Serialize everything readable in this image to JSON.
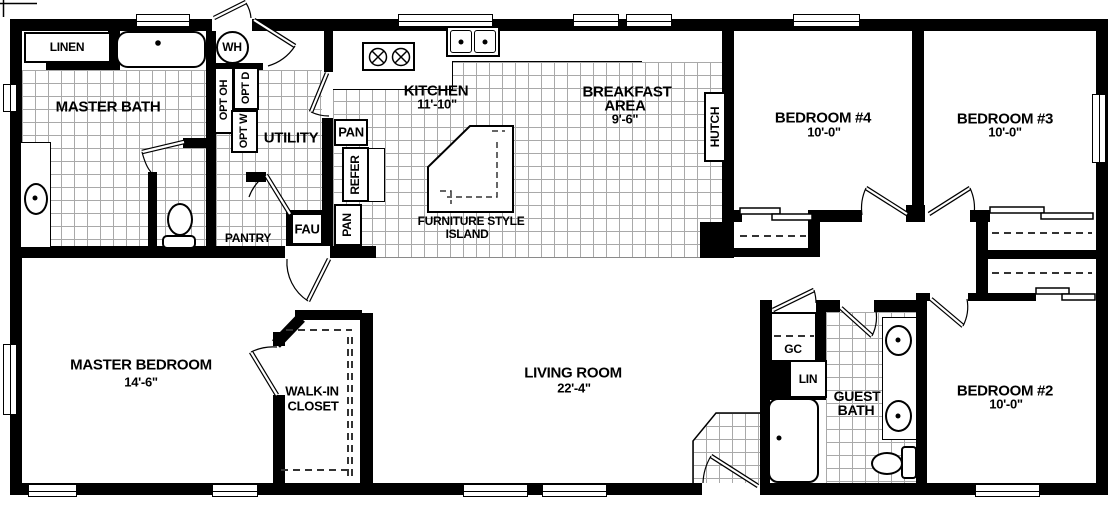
{
  "plan_title": "floor-plan",
  "rooms": {
    "master_bath": {
      "name": "MASTER BATH"
    },
    "utility": {
      "name": "UTILITY"
    },
    "pantry": {
      "name": "PANTRY"
    },
    "kitchen": {
      "name": "KITCHEN",
      "dim": "11'-10\""
    },
    "breakfast": {
      "line1": "BREAKFAST",
      "line2": "AREA",
      "dim": "9'-6\""
    },
    "bedroom4": {
      "name": "BEDROOM #4",
      "dim": "10'-0\""
    },
    "bedroom3": {
      "name": "BEDROOM #3",
      "dim": "10'-0\""
    },
    "bedroom2": {
      "name": "BEDROOM #2",
      "dim": "10'-0\""
    },
    "master_bedroom": {
      "name": "MASTER BEDROOM",
      "dim": "14'-6\""
    },
    "walkin_closet": {
      "line1": "WALK-IN",
      "line2": "CLOSET"
    },
    "living_room": {
      "name": "LIVING ROOM",
      "dim": "22'-4\""
    },
    "guest_bath": {
      "line1": "GUEST",
      "line2": "BATH"
    },
    "island": {
      "line1": "FURNITURE STYLE",
      "line2": "ISLAND"
    }
  },
  "fixtures": {
    "linen": "LINEN",
    "water_heater": "WH",
    "opt_overhead": "OPT OH",
    "opt_dryer": "OPT D",
    "opt_washer": "OPT W",
    "pan_upper": "PAN",
    "refrigerator": "REFER",
    "pan_lower": "PAN",
    "fau": "FAU",
    "hutch": "HUTCH",
    "gc": "GC",
    "lin": "LIN"
  },
  "colors": {
    "wall": "#000000",
    "background": "#ffffff",
    "tile_line": "#a9a9a9"
  }
}
